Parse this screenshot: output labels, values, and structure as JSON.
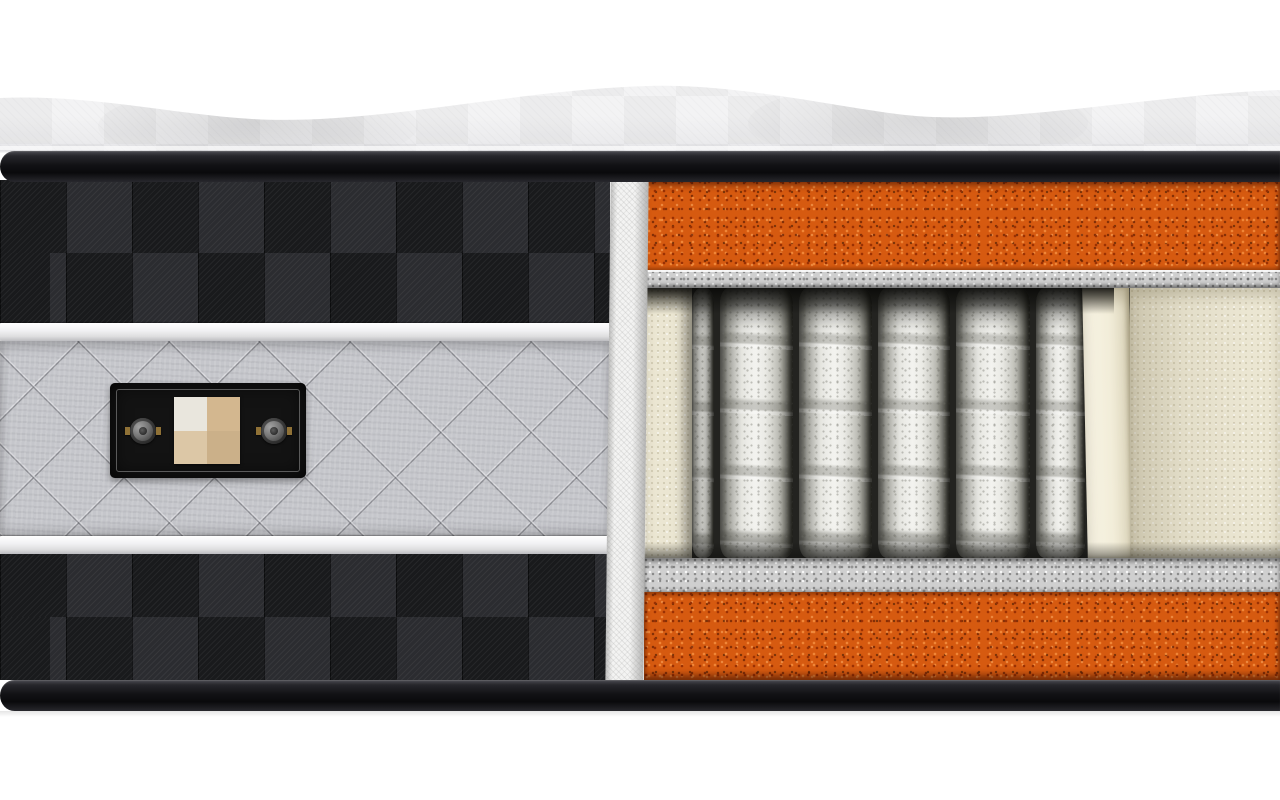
{
  "image": {
    "type": "3d-product-render",
    "subject": "mattress cross-section cutaway showing internal layers",
    "background_color": "#ffffff"
  },
  "exterior": {
    "quilted_top": {
      "description": "wavy quilted pillow-top surface",
      "color": "#f2f2f3",
      "shade_color": "#e4e4e7"
    },
    "top_rail": {
      "description": "black edge rail",
      "color": "#121215"
    },
    "bottom_rail": {
      "description": "black edge rail",
      "color": "#121215"
    },
    "side_panel": {
      "upper_checker": {
        "description": "dark checkered fabric band, 2 rows",
        "square_colors": [
          "#191a1c",
          "#2b2c30"
        ],
        "rows": 2
      },
      "upper_piping": {
        "description": "white piping cord",
        "color": "#f2f2f4"
      },
      "quilted_band": {
        "description": "gray diamond-quilted fabric band",
        "color": "#c5c6cb",
        "seam_color": "#5c5d63"
      },
      "lower_piping": {
        "description": "white piping cord",
        "color": "#f2f2f4"
      },
      "lower_checker": {
        "description": "dark checkered fabric band, 2 rows",
        "square_colors": [
          "#191a1c",
          "#2b2c30"
        ],
        "rows": 2
      }
    },
    "label": {
      "description": "black fabric patch with stitched border, two metal vents and a four-square swatch",
      "background": "#131313",
      "stitch_color": "#a5a5a5",
      "vent_count": 2,
      "vent_color": "#757575",
      "vent_tab_color": "#8f7136",
      "swatch_colors": {
        "top_left": "#e9e6dd",
        "top_right": "#d3b78f",
        "bottom_left": "#dcc7a6",
        "bottom_right": "#cbb089"
      }
    }
  },
  "cross_section": {
    "cut_edge_fabric": {
      "description": "white cut fabric edge strip",
      "color": "#f3f3f2"
    },
    "layers": [
      {
        "name": "top comfort foam",
        "color": "#d65a10",
        "speckle_colors": [
          "#962d02",
          "#f48c3c"
        ]
      },
      {
        "name": "top felt pad",
        "color": "#cfcfcf"
      },
      {
        "name": "pocket spring core",
        "spring_fabric_color": "#f0f0ec",
        "springs_visible": 6,
        "cavity_shadow_color": "#232320",
        "foam_wall_color": "#ebe6d2",
        "foam_edge_highlight": "#f9f5e6"
      },
      {
        "name": "bottom felt pad",
        "color": "#cfcfcf"
      },
      {
        "name": "bottom support foam",
        "color": "#d65a10"
      }
    ]
  }
}
